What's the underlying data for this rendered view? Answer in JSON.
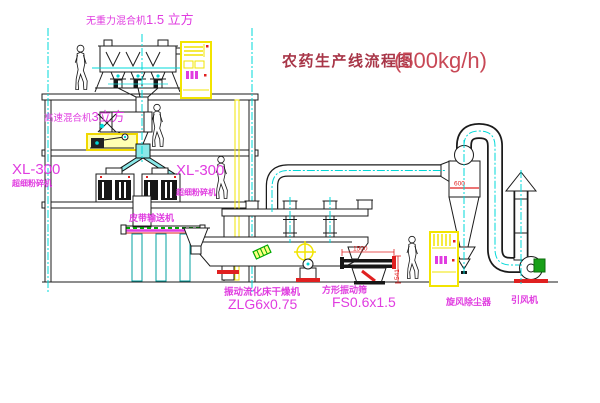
{
  "title": {
    "text": "农药生产线流程图",
    "capacity": "(500kg/h)"
  },
  "labels": {
    "gravity_mixer_name": "无重力混合机",
    "gravity_mixer_volume": "1.5 立方",
    "high_speed_mixer_name": "高速混合机",
    "high_speed_mixer_volume": "3立方",
    "mill_left_model": "XL-300",
    "mill_left_name": "超细粉碎机",
    "mill_right_model": "XL-300",
    "mill_right_name": "超细粉碎机",
    "belt_conveyor": "皮带输送机",
    "dryer_name": "振动流化床干燥机",
    "dryer_model": "ZLG6x0.75",
    "sieve_name": "方形振动筛",
    "sieve_model": "FS0.6x1.5",
    "cyclone_name": "旋风除尘器",
    "fan_name": "引风机"
  },
  "dimensions": {
    "cyclone_diameter": "600",
    "sieve_length": "1500",
    "sieve_height": "541"
  },
  "colors": {
    "label_magenta": "#e03ce0",
    "title_red": "#a83648",
    "dimension_red": "#e02020",
    "centerline_cyan": "#00d8d8",
    "highlight_yellow": "#f2e400",
    "machine_green": "#00a800"
  }
}
